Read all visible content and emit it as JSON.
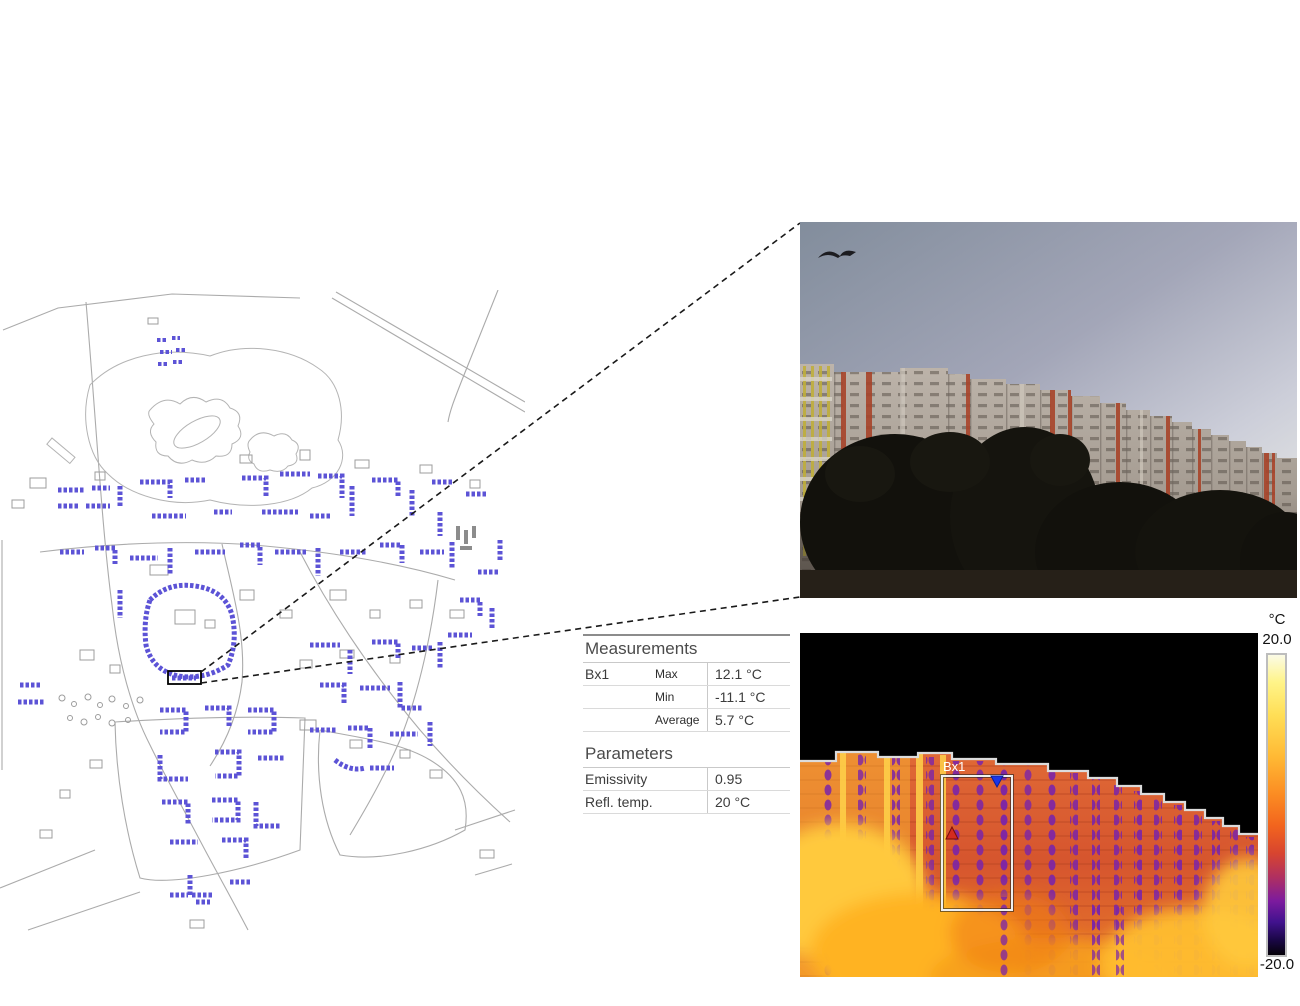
{
  "measurements": {
    "title": "Measurements",
    "rows": [
      {
        "label": "Bx1",
        "stat": "Max",
        "value": "12.1 °C"
      },
      {
        "label": "",
        "stat": "Min",
        "value": "-11.1 °C"
      },
      {
        "label": "",
        "stat": "Average",
        "value": "5.7 °C"
      }
    ]
  },
  "parameters": {
    "title": "Parameters",
    "rows": [
      {
        "label": "Emissivity",
        "value": "0.95"
      },
      {
        "label": "Refl. temp.",
        "value": "20 °C"
      }
    ]
  },
  "thermal": {
    "roi_label": "Bx1",
    "scale_unit": "°C",
    "scale_max": "20.0",
    "scale_min": "-20.0"
  },
  "colors": {
    "map_highlight_blue": "#5c53d6",
    "map_linework_gray": "#ababab",
    "roi_outline_black": "#000000",
    "connector_line": "#1a1a1a",
    "thermal_hot": "#fbfbe6",
    "thermal_cold": "#050208",
    "roi_max_marker_red": "#d42b20",
    "roi_min_marker_blue": "#1a35e8"
  }
}
